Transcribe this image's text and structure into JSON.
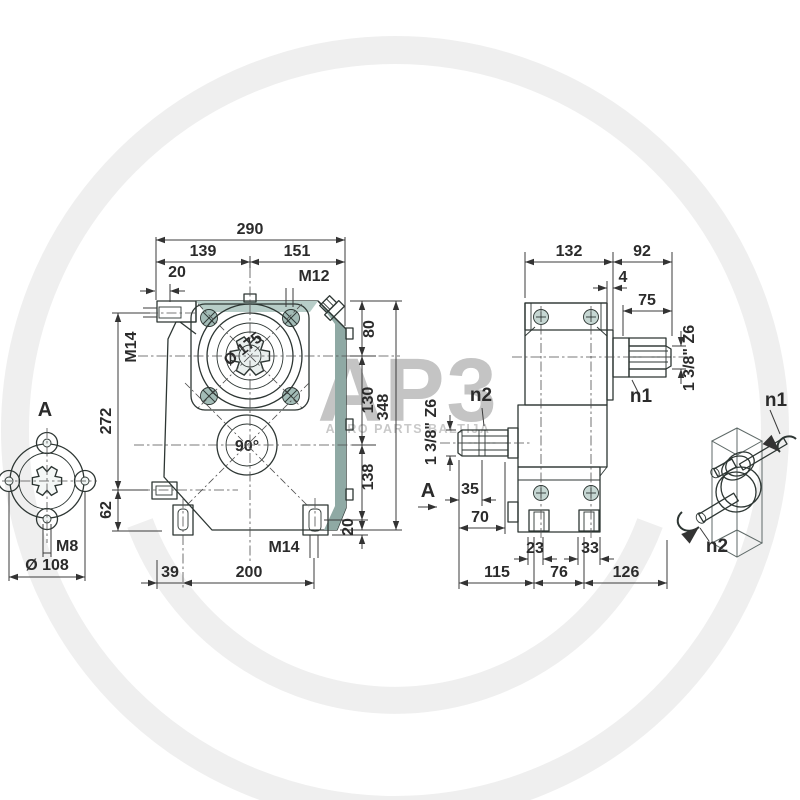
{
  "watermark": {
    "logo": "AP3",
    "subtitle": "AGRO PARTS BALTIJA"
  },
  "front_view": {
    "dim_290": "290",
    "dim_139": "139",
    "dim_151": "151",
    "dim_20_top": "20",
    "thread_m12": "M12",
    "thread_m14_left": "M14",
    "dim_272": "272",
    "dim_62": "62",
    "dim_80": "80",
    "dim_130": "130",
    "dim_138": "138",
    "dim_20_right": "20",
    "dim_348": "348",
    "bore_diameter": "Ø 175",
    "gear_angle": "90°",
    "thread_m14_bottom": "M14",
    "dim_39": "39",
    "dim_200": "200"
  },
  "side_view": {
    "dim_132": "132",
    "dim_92": "92",
    "dim_4": "4",
    "dim_75": "75",
    "shaft_spec_n1": "1 3/8\" Z6",
    "shaft_spec_n2": "1 3/8\" Z6",
    "label_n1": "n1",
    "label_n2": "n2",
    "view_arrow_label": "A",
    "dim_35": "35",
    "dim_70": "70",
    "dim_23": "23",
    "dim_33": "33",
    "dim_115": "115",
    "dim_76": "76",
    "dim_126": "126"
  },
  "view_a": {
    "title": "A",
    "thread_m8": "M8",
    "dim_dia_108": "Ø 108"
  },
  "schematic": {
    "label_n1": "n1",
    "label_n2": "n2"
  },
  "colors": {
    "housing": "#a3bcb7",
    "housing_light": "#b7cdc8",
    "housing_dark": "#8fa9a4",
    "line": "#2d3633",
    "watermark": "#efefef"
  }
}
